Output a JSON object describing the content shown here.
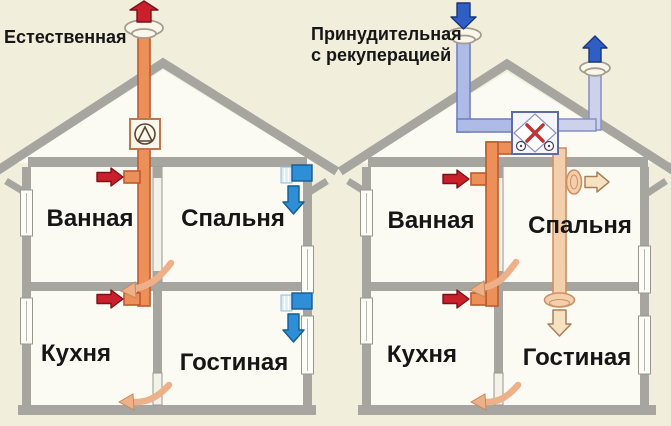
{
  "houses": {
    "left": {
      "title": "Естественная",
      "rooms": {
        "bathroom": "Ванная",
        "bedroom": "Спальня",
        "kitchen": "Кухня",
        "living_room": "Гостиная"
      }
    },
    "right": {
      "title_line1": "Принудительная",
      "title_line2": "с рекуперацией",
      "rooms": {
        "bathroom": "Ванная",
        "bedroom": "Спальня",
        "kitchen": "Кухня",
        "living_room": "Гостиная"
      }
    }
  },
  "colors": {
    "background": "#f1efdc",
    "wall_gray": "#a6a5a0",
    "room_white": "#fcfbf3",
    "exhaust_pipe_orange": "#ec8f58",
    "exhaust_pipe_stroke": "#bc5b2e",
    "supply_pipe_pale": "#f4cfac",
    "supply_pipe_stroke": "#cd9064",
    "intake_pipe_blue": "#aebbe6",
    "intake_pipe_stroke": "#7283c0",
    "outflow_pipe_lavender": "#ccd2ec",
    "arrow_red": "#c9202c",
    "arrow_red_stroke": "#7c1118",
    "arrow_deep_blue": "#2f5fc4",
    "arrow_sky_blue": "#2e8fd6",
    "arrow_cream": "#f6e2c0",
    "arrow_cream_stroke": "#a8805c",
    "curved_arrow_peach": "#eeb088",
    "text_black": "#161616"
  }
}
